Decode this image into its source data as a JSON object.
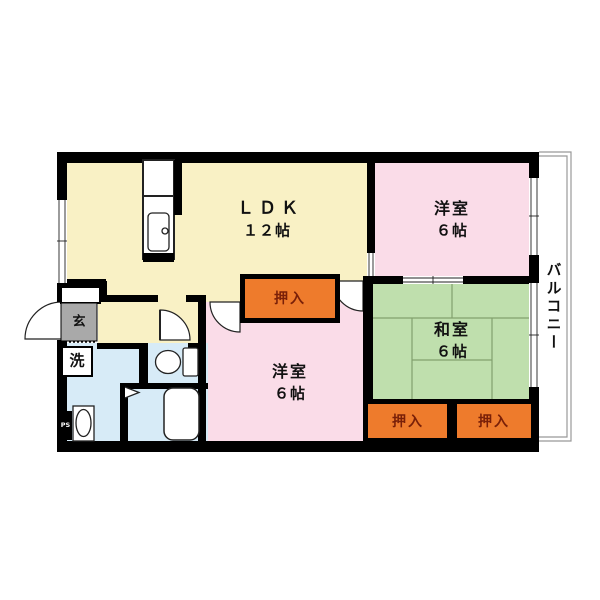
{
  "title": "3LDK apartment floor plan",
  "rooms": {
    "ldk": {
      "name": "ＬＤＫ",
      "size": "１２帖"
    },
    "western_upper": {
      "name": "洋室",
      "size": "６帖"
    },
    "western_lower": {
      "name": "洋室",
      "size": "６帖"
    },
    "japanese": {
      "name": "和室",
      "size": "６帖"
    },
    "closet_hall": {
      "label": "押入"
    },
    "closet_left": {
      "label": "押入"
    },
    "closet_right": {
      "label": "押入"
    },
    "entrance": {
      "label": "玄"
    },
    "laundry": {
      "label": "洗"
    },
    "pipe_space": {
      "label": "PS"
    },
    "balcony": {
      "label": "バルコニー"
    }
  },
  "colors": {
    "wall": "#000000",
    "ldk_floor": "#f9f1c5",
    "western_floor": "#fadce8",
    "tatami_floor": "#bfdfad",
    "tatami_line": "#82a06e",
    "wet_floor": "#d7ebf7",
    "closet_fill": "#ee7b2c",
    "closet_text": "#7a2008",
    "entrance_floor": "#a9a9a9",
    "balcony_line": "#999999",
    "fixture_fill": "#ffffff"
  }
}
